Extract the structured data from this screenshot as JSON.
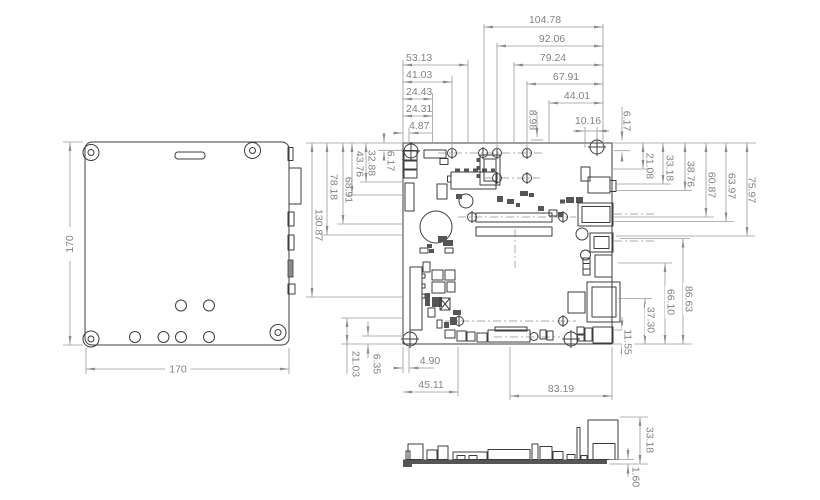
{
  "dimensions": {
    "enclosure": {
      "width": "170",
      "height": "170"
    },
    "top_left": [
      "53.13",
      "41.03",
      "24.43",
      "24.31",
      "4.87"
    ],
    "top_right": [
      "104.78",
      "92.06",
      "79.24",
      "67.91",
      "44.01"
    ],
    "top_mid": [
      "8.98",
      "10.16",
      "6.17"
    ],
    "left": [
      "130.87",
      "78.18",
      "68.91",
      "43.76",
      "32.88",
      "6.17"
    ],
    "right_upper": [
      "21.08",
      "33.18",
      "38.76",
      "60.87",
      "63.97",
      "75.97"
    ],
    "right_lower": [
      "11.55",
      "37.30",
      "66.10",
      "86.63"
    ],
    "bottom": [
      "4.90",
      "45.11",
      "83.19"
    ],
    "bottom_left": [
      "21.03",
      "6.35"
    ],
    "side": [
      "33.18",
      "1.60"
    ]
  },
  "colors": {
    "outline": "#3c3c3c",
    "dimension": "#8c8c8c",
    "background": "#ffffff"
  }
}
